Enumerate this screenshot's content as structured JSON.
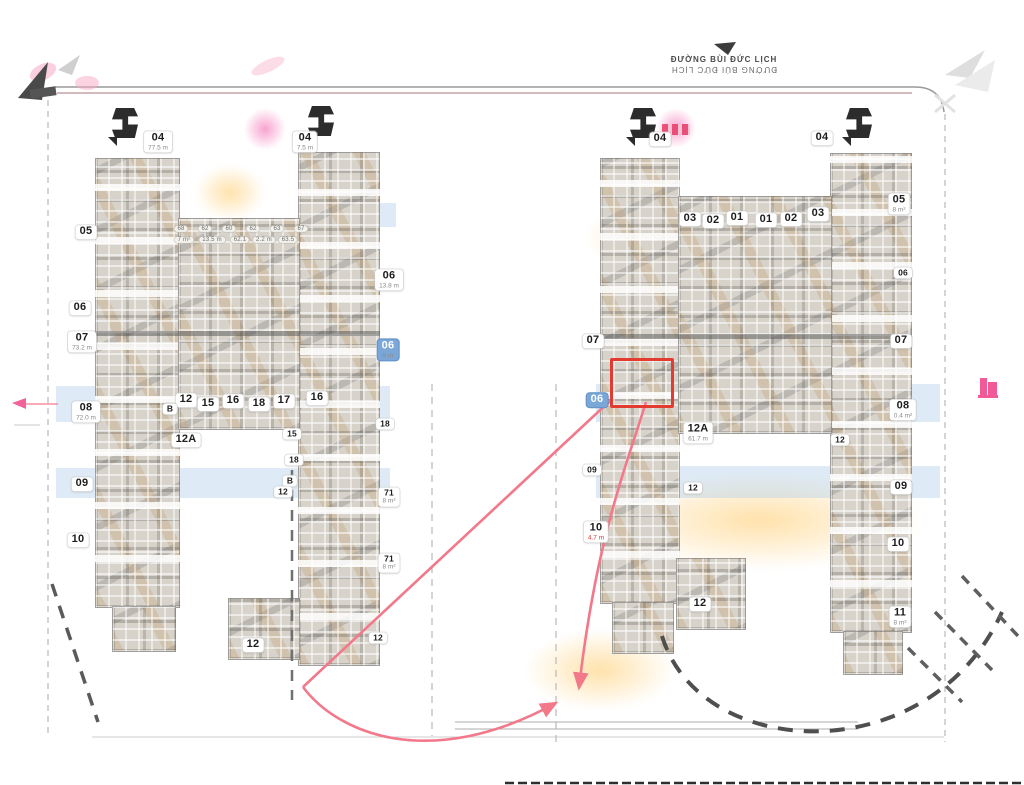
{
  "street_top": {
    "line1": "ĐƯỜNG BÙI ĐỨC LỊCH",
    "line2": "ĐƯỜNG BÙI ĐỨC LỊCH"
  },
  "colors": {
    "highlight_red": "#e23b30",
    "leader_pink": "#f2798a",
    "magenta_accent": "#ee2d7a",
    "blue_label": "#7aa7d8",
    "mosaic_base": "#d8d3ca"
  },
  "icons": [
    "north-compass-icon",
    "tower-marker-icon",
    "pink-building-icon",
    "pink-arrow-icon",
    "faint-arrow-icon"
  ],
  "highlight": {
    "note": "red outlined unit, right tower left wing"
  },
  "labels": {
    "units": [
      {
        "t": "05",
        "x": 86,
        "y": 232
      },
      {
        "t": "06",
        "x": 80,
        "y": 308
      },
      {
        "t": "07",
        "x": 82,
        "y": 342,
        "a": "73.2 m"
      },
      {
        "t": "08",
        "x": 86,
        "y": 412,
        "a": "72.0 m"
      },
      {
        "t": "09",
        "x": 82,
        "y": 484
      },
      {
        "t": "10",
        "x": 78,
        "y": 540
      },
      {
        "t": "04",
        "x": 158,
        "y": 142,
        "a": "77.5 m"
      },
      {
        "t": "04",
        "x": 305,
        "y": 142,
        "a": "7.5 m"
      },
      {
        "t": "12",
        "x": 186,
        "y": 400
      },
      {
        "t": "15",
        "x": 208,
        "y": 404
      },
      {
        "t": "16",
        "x": 233,
        "y": 401
      },
      {
        "t": "18",
        "x": 259,
        "y": 404
      },
      {
        "t": "17",
        "x": 284,
        "y": 401
      },
      {
        "t": "16",
        "x": 317,
        "y": 398
      },
      {
        "t": "B",
        "x": 170,
        "y": 409,
        "cls": "small"
      },
      {
        "t": "12A",
        "x": 186,
        "y": 440
      },
      {
        "t": "15",
        "x": 292,
        "y": 434,
        "cls": "small"
      },
      {
        "t": "18",
        "x": 294,
        "y": 460,
        "cls": "small"
      },
      {
        "t": "B",
        "x": 290,
        "y": 481,
        "cls": "small"
      },
      {
        "t": "12",
        "x": 283,
        "y": 492,
        "cls": "small"
      },
      {
        "t": "12",
        "x": 253,
        "y": 645
      },
      {
        "t": "06",
        "x": 389,
        "y": 280,
        "a": "13.8 m"
      },
      {
        "t": "06",
        "x": 388,
        "y": 350,
        "a": "9 m",
        "cls": "blue"
      },
      {
        "t": "18",
        "x": 385,
        "y": 424,
        "cls": "small"
      },
      {
        "t": "71",
        "x": 389,
        "y": 497,
        "a": "8 m²",
        "cls": "small"
      },
      {
        "t": "71",
        "x": 389,
        "y": 563,
        "a": "8 m²",
        "cls": "small"
      },
      {
        "t": "12",
        "x": 378,
        "y": 638,
        "cls": "small"
      },
      {
        "t": "04",
        "x": 660,
        "y": 139
      },
      {
        "t": "04",
        "x": 822,
        "y": 138
      },
      {
        "t": "03",
        "x": 690,
        "y": 219
      },
      {
        "t": "02",
        "x": 713,
        "y": 221
      },
      {
        "t": "01",
        "x": 737,
        "y": 218
      },
      {
        "t": "01",
        "x": 766,
        "y": 220
      },
      {
        "t": "02",
        "x": 791,
        "y": 219
      },
      {
        "t": "03",
        "x": 818,
        "y": 214
      },
      {
        "t": "07",
        "x": 593,
        "y": 341
      },
      {
        "t": "06",
        "x": 597,
        "y": 400,
        "cls": "blue"
      },
      {
        "t": "09",
        "x": 592,
        "y": 470,
        "cls": "small"
      },
      {
        "t": "10",
        "x": 596,
        "y": 532,
        "a": "4.7 m",
        "cls": "redarea"
      },
      {
        "t": "12A",
        "x": 698,
        "y": 433,
        "a": "61.7 m"
      },
      {
        "t": "12",
        "x": 693,
        "y": 488,
        "cls": "small"
      },
      {
        "t": "12",
        "x": 840,
        "y": 440,
        "cls": "small"
      },
      {
        "t": "12",
        "x": 700,
        "y": 604
      },
      {
        "t": "05",
        "x": 899,
        "y": 204,
        "a": "8 m²"
      },
      {
        "t": "06",
        "x": 903,
        "y": 273,
        "cls": "small"
      },
      {
        "t": "07",
        "x": 901,
        "y": 341
      },
      {
        "t": "08",
        "x": 903,
        "y": 410,
        "a": "0.4 m²"
      },
      {
        "t": "09",
        "x": 901,
        "y": 487
      },
      {
        "t": "10",
        "x": 898,
        "y": 544
      },
      {
        "t": "11",
        "x": 900,
        "y": 617,
        "a": "8 m²"
      }
    ],
    "tiny": [
      {
        "t": "68",
        "x": 181,
        "y": 229
      },
      {
        "t": "62",
        "x": 205,
        "y": 229
      },
      {
        "t": "60",
        "x": 229,
        "y": 229
      },
      {
        "t": "62",
        "x": 253,
        "y": 229
      },
      {
        "t": "63",
        "x": 277,
        "y": 229
      },
      {
        "t": "67",
        "x": 301,
        "y": 229
      },
      {
        "t": "7 m²",
        "x": 184,
        "y": 240
      },
      {
        "t": "13.5 m",
        "x": 212,
        "y": 240
      },
      {
        "t": "62.1",
        "x": 240,
        "y": 240
      },
      {
        "t": "2.2 m",
        "x": 264,
        "y": 240
      },
      {
        "t": "63.5",
        "x": 288,
        "y": 240
      }
    ]
  },
  "markers": [
    {
      "x": 112,
      "y": 108
    },
    {
      "x": 308,
      "y": 106
    },
    {
      "x": 630,
      "y": 108
    },
    {
      "x": 846,
      "y": 108
    }
  ]
}
